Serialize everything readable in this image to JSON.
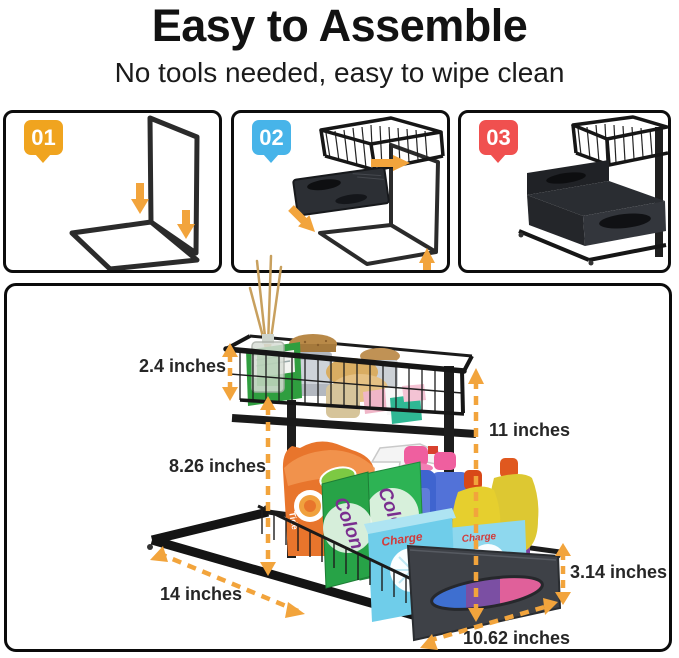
{
  "header": {
    "title": "Easy to Assemble",
    "subtitle": "No tools needed, easy to wipe clean"
  },
  "steps": [
    {
      "number": "01",
      "badge_color": "#F0A41F",
      "illustration": "frame-assembly-step"
    },
    {
      "number": "02",
      "badge_color": "#47B4E9",
      "illustration": "attach-basket-and-drawer-step"
    },
    {
      "number": "03",
      "badge_color": "#F0504F",
      "illustration": "assembled-organizer-step"
    }
  ],
  "dimensions": [
    {
      "id": "basket-height",
      "label": "2.4 inches"
    },
    {
      "id": "middle-height",
      "label": "8.26 inches"
    },
    {
      "id": "total-height",
      "label": "11 inches"
    },
    {
      "id": "rail-length",
      "label": "14 inches"
    },
    {
      "id": "drawer-height",
      "label": "3.14 inches"
    },
    {
      "id": "drawer-width",
      "label": "10.62 inches"
    }
  ],
  "product": {
    "type": "2-tier sliding under-sink organizer",
    "brand_texts": {
      "green_box": "Colon",
      "blue_box": "Charge",
      "bag": "Tide"
    },
    "top_basket_items": [
      "reed-diffuser",
      "green-soap-box",
      "cork-lid-jar-large",
      "cork-lid-jar-small",
      "round-soap-bars",
      "mini-soap-boxes"
    ],
    "drawer_items": [
      "orange-detergent-bag",
      "spray-trigger-bottle",
      "blue-bottles-pink-caps",
      "green-detergent-boxes",
      "light-blue-detergent-boxes",
      "yellow-dish-soap-bottles",
      "purple-bottle"
    ]
  },
  "colors": {
    "arrow_accent": "#F2A43C",
    "step1_badge": "#F0A41F",
    "step2_badge": "#47B4E9",
    "step3_badge": "#F0504F",
    "frame_black": "#1c1c1c",
    "panel_border": "#0d0d0d"
  }
}
